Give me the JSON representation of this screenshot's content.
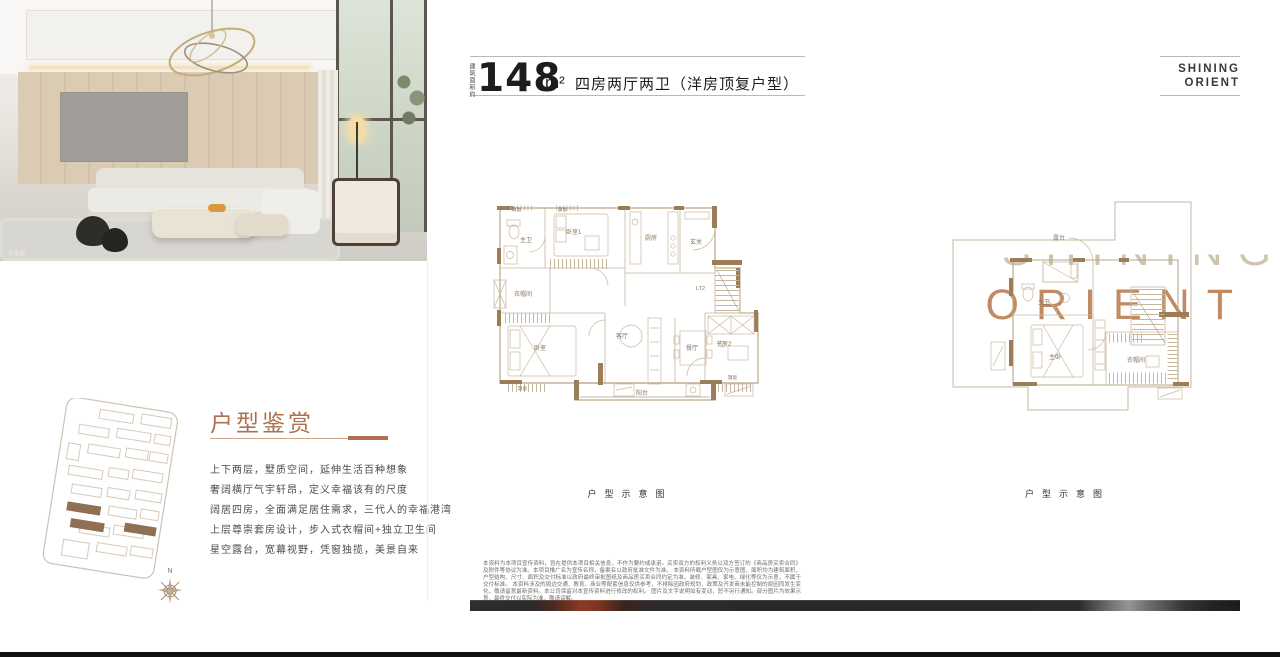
{
  "photo": {
    "caption": "效果图",
    "overlay_line1": "SHINING",
    "overlay_line2": "ORIENT"
  },
  "left_panel": {
    "section_title": "户型鉴赏",
    "description_lines": [
      "上下两层，墅质空间，延伸生活百种想象",
      "奢阔横厅气宇轩昂，定义幸福该有的尺度",
      "阔居四房，全面满足居住需求，三代人的幸福港湾",
      "上层尊崇套房设计，步入式衣帽间+独立卫生间",
      "星空露台，宽幕视野，凭窗独揽，美景自来"
    ],
    "compass_label": "N"
  },
  "header": {
    "area_label_vertical": "建筑面积约",
    "area_value": "148",
    "area_unit": "m²",
    "title": "四房两厅两卫（洋房顶复户型）",
    "brand_line1": "SHINING",
    "brand_line2": "ORIENT"
  },
  "floorplan_lower": {
    "caption": "户型示意图",
    "rooms": {
      "bay_window": "飘窗",
      "bedroom1": "卧室1",
      "master_bath": "主卫",
      "kitchen": "厨房",
      "entry": "玄关",
      "cloakroom": "衣帽间",
      "bedroom": "卧室",
      "living": "客厅",
      "dining": "餐厅",
      "study2": "书房2",
      "stairs": "LT2",
      "balcony": "阳台"
    }
  },
  "floorplan_upper": {
    "caption": "户型示意图",
    "rooms": {
      "terrace": "露台",
      "master_bath": "主卫",
      "master_bedroom": "主卧",
      "cloakroom": "衣帽间"
    }
  },
  "disclaimer_lines": [
    "本资料为本项目宣传资料，旨在提供本项目相关信息，不作为要约或承诺。买卖双方的权利义务以双方签订的《商品房买卖合同》及附件等协议为准。本项目推广名为宣传名称，备案名以政府批准文件为准。",
    "本资料所载户型图仅为示意图，面积均为建筑面积，户型结构、尺寸、面积及交付标准以政府最终审批图纸及商品房买卖合同约定为准。装修、家具、家电、绿化等仅为示意，不属于交付标准。",
    "本资料涉及的周边交通、教育、商业等配套信息仅供参考，不排除因政府规划、政策及开发商未能控制的原因而发生变化，敬请留意最新资料。本公司保留对本宣传资料进行修改的权利。",
    "图片及文字说明如有变动，恕不另行通知。部分图片为效果示意，最终交付以实际为准，敬请谅解。"
  ],
  "colors": {
    "accent_brown": "#b06f4d",
    "orient_tan": "#c18a63",
    "plan_wall": "#9b7d58",
    "bar_dark": "#2b2b2b",
    "bar_red": "#8a3b24",
    "bar_gray": "#8f8f8f"
  }
}
